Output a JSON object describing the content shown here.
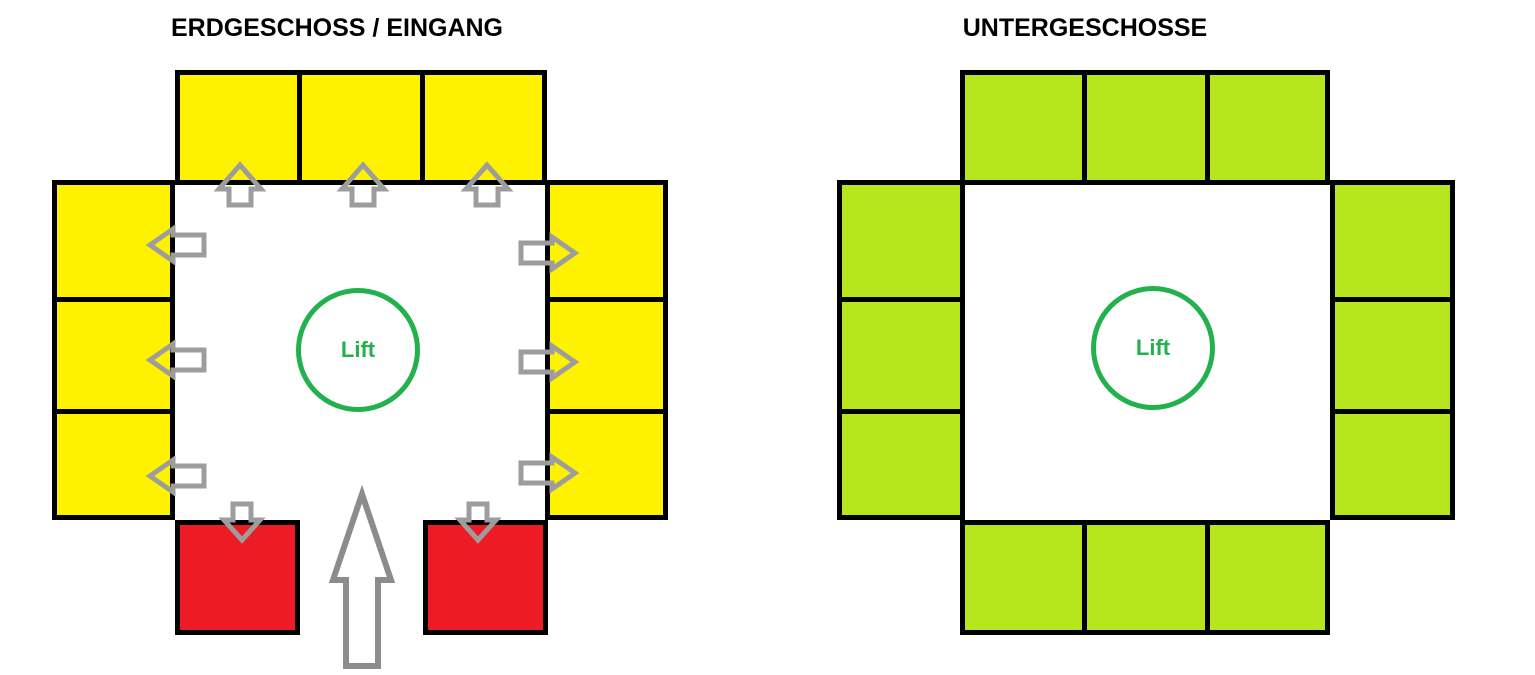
{
  "colors": {
    "background": "#FFFFFF",
    "outline_black": "#000000",
    "room_yellow": "#FFF200",
    "exit_red": "#ED1C24",
    "basement_green": "#B5E61D",
    "lift_green": "#22B14C",
    "arrow_gray": "#9D9D9D",
    "entrance_arrow_gray": "#8C8C8C"
  },
  "ground_floor": {
    "title": "ERDGESCHOSS / EINGANG",
    "lift_label": "Lift",
    "rooms": {
      "top": 3,
      "left": 3,
      "right": 3,
      "bottom_exit_rooms": 2
    },
    "arrows": {
      "into_top_rooms": 3,
      "into_left_rooms": 3,
      "into_right_rooms": 3,
      "into_exit_rooms": 2,
      "entrance_from_bottom": 1
    }
  },
  "basement": {
    "title": "UNTERGESCHOSSE",
    "lift_label": "Lift",
    "rooms": {
      "top": 3,
      "left": 3,
      "right": 3,
      "bottom": 3
    }
  }
}
